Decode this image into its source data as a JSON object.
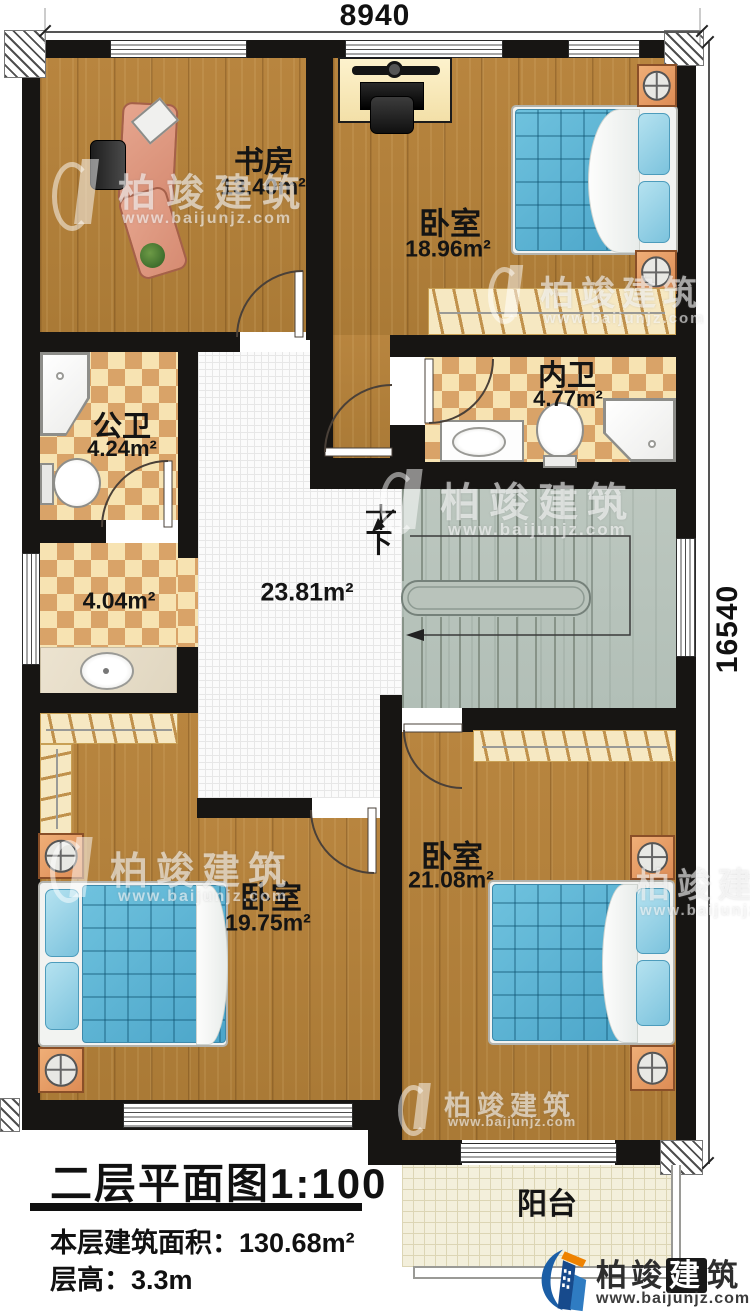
{
  "dimensions": {
    "width_label": "8940",
    "height_label": "16540"
  },
  "rooms": {
    "study": {
      "name": "书房",
      "area": "13.40m²"
    },
    "bedroom_top": {
      "name": "卧室",
      "area": "18.96m²"
    },
    "bath_inner": {
      "name": "内卫",
      "area": "4.77m²"
    },
    "bath_public": {
      "name": "公卫",
      "area": "4.24m²"
    },
    "dressing": {
      "area": "4.04m²"
    },
    "hall": {
      "area": "23.81m²"
    },
    "bedroom_left": {
      "name": "卧室",
      "area": "19.75m²"
    },
    "bedroom_right": {
      "name": "卧室",
      "area": "21.08m²"
    },
    "balcony": {
      "name": "阳台"
    }
  },
  "stairs": {
    "down_label": "下"
  },
  "title_block": {
    "title": "二层平面图1:100",
    "area_line": "本层建筑面积：130.68m²",
    "height_line": "层高：3.3m"
  },
  "watermark": {
    "name": "柏竣建筑",
    "url": "www.baijunjz.com"
  },
  "branding": {
    "name_prefix": "柏竣",
    "name_boxed": "建",
    "name_suffix": "筑",
    "url": "www.baijunjz.com"
  },
  "colors": {
    "wall": "#171513",
    "wood": "#b0803c",
    "bed": "#5cb4d6",
    "accent_orange": "#ee8200",
    "brand_blue": "#1b5ea6"
  }
}
